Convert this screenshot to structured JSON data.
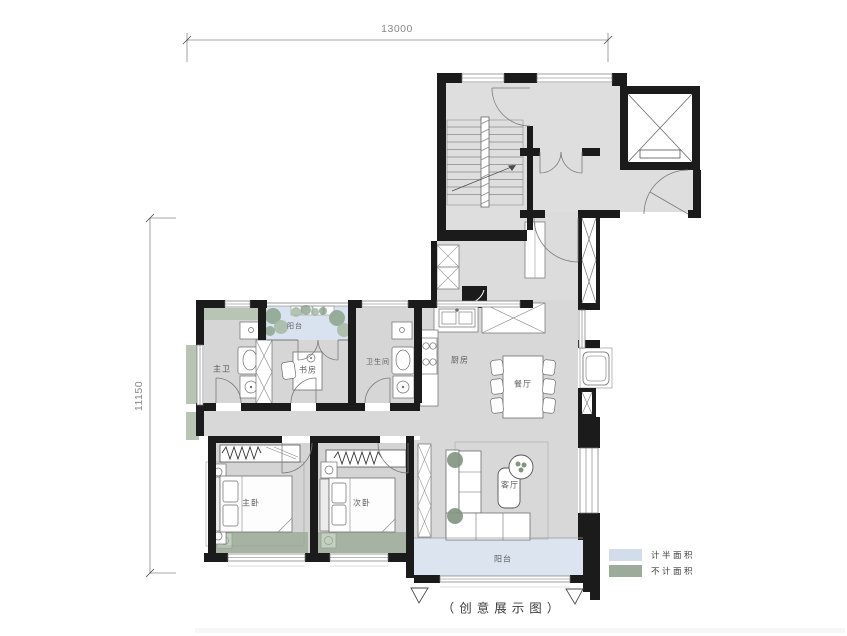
{
  "caption": "（创意展示图）",
  "dimensions": {
    "top_width": "13000",
    "left_height": "11150"
  },
  "rooms": {
    "master_bath": "主卫",
    "study": "书房",
    "north_balcony": "阳台",
    "bathroom": "卫生间",
    "kitchen": "厨房",
    "dining": "餐厅",
    "master_bedroom": "主卧",
    "second_bedroom": "次卧",
    "living_room": "客厅",
    "south_balcony": "阳台"
  },
  "legend": {
    "items": [
      {
        "label": "计半面积",
        "color": "#d3dcea",
        "style": "background:#d3dcea"
      },
      {
        "label": "不计面积",
        "color": "#9dab9b",
        "style": "background:#9dab9b"
      }
    ]
  },
  "colors": {
    "wall": "#1b1b1b",
    "room_floor": "#d8d8d8",
    "core_floor": "#dedede",
    "half_area_blue": "#d9e2ef",
    "excluded_green_dark": "#a6b3a2",
    "excluded_green_light": "#b9c5b4",
    "plant_green": "#86a087",
    "furniture_stroke": "#6e6e6e"
  }
}
